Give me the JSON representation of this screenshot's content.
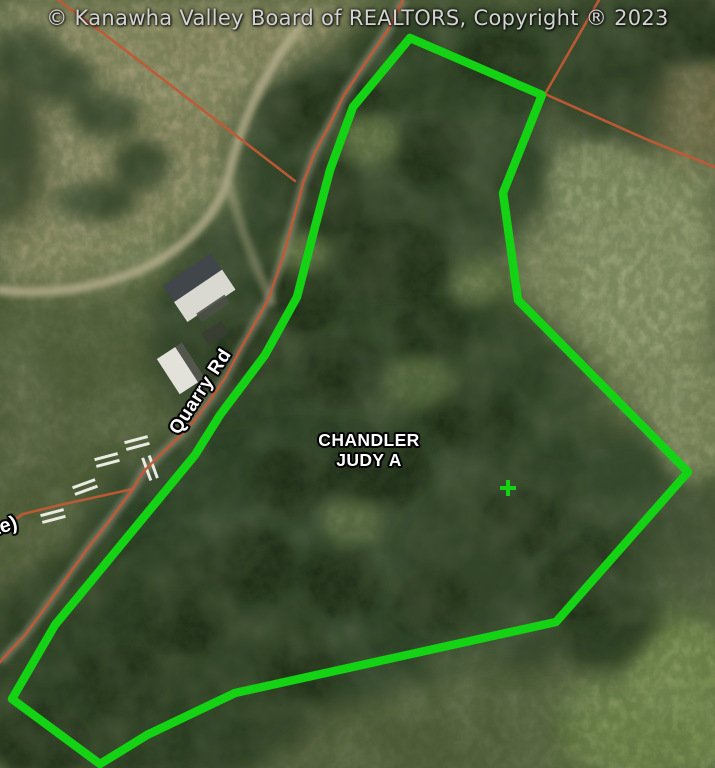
{
  "attribution": {
    "text": "© Kanawha Valley Board of REALTORS, Copyright  ® 2023"
  },
  "map": {
    "parcel_label": {
      "line1": "CHANDLER",
      "line2": "JUDY A"
    },
    "road_label": "Quarry Rd",
    "partial_road_label": "te)"
  },
  "icons": {
    "centroid_marker": "plus-cross-icon"
  },
  "colors": {
    "parcel_outline": "#14d214",
    "road_line": "#c05a36",
    "attribution_text": "#d3d3d3",
    "label_text": "#ffffff"
  }
}
